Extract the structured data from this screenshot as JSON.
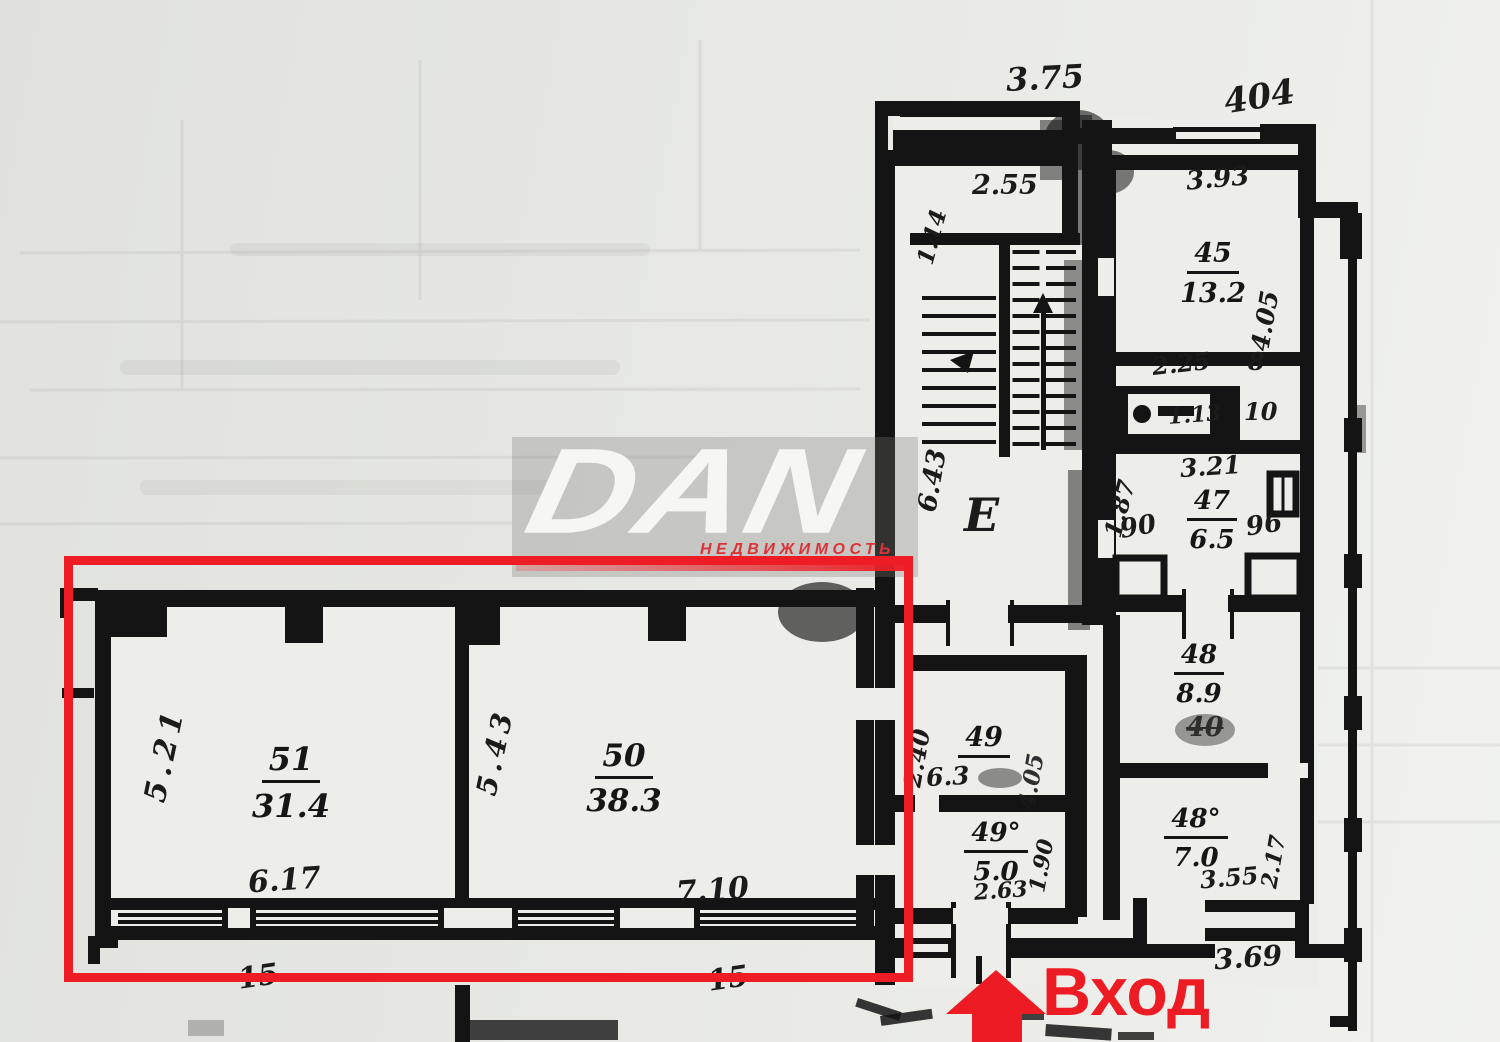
{
  "watermark": {
    "logo": "DAN",
    "tagline": "НЕДВИЖИМОСТЬ"
  },
  "entrance": {
    "label": "Вход"
  },
  "colors": {
    "highlight_red": "#ee1c25",
    "ink": "#161616",
    "paper": "#e8e9e5"
  },
  "plan": {
    "exterior": {
      "top_width": "3.75",
      "house_number": "404",
      "bottom_right_width": "3.69"
    },
    "highlighted": {
      "room51": {
        "number": "51",
        "area": "31.4",
        "width": "6.17",
        "depth": "5.21",
        "axis": "15"
      },
      "room50": {
        "number": "50",
        "area": "38.3",
        "width": "7.10",
        "depth": "5.43",
        "axis": "15"
      }
    },
    "stairwell": {
      "letter": "E",
      "vestibule_width": "2.55",
      "vestibule_depth": "1.14",
      "flight_depth": "6.43"
    },
    "rooms": {
      "r45": {
        "number": "45",
        "area": "13.2",
        "width": "3.93",
        "depth": "4.05"
      },
      "closets": {
        "dim1": "2.25",
        "dim2": "8",
        "dim3": "1.13",
        "dim4": "10"
      },
      "r47": {
        "number": "47",
        "area": "6.5",
        "width": "3.21",
        "depth": "1.87",
        "door1": "90",
        "door2": "96"
      },
      "r48": {
        "number": "48",
        "area": "8.9",
        "crossed": "40"
      },
      "r48a": {
        "number": "48°",
        "area": "7.0",
        "width": "3.55",
        "depth": "2.17"
      },
      "r49": {
        "number": "49",
        "area": "6.3",
        "depth": "2.40",
        "side": "4.05"
      },
      "r49a": {
        "number": "49°",
        "area": "5.0",
        "width": "2.63",
        "depth": "1.90"
      }
    }
  }
}
